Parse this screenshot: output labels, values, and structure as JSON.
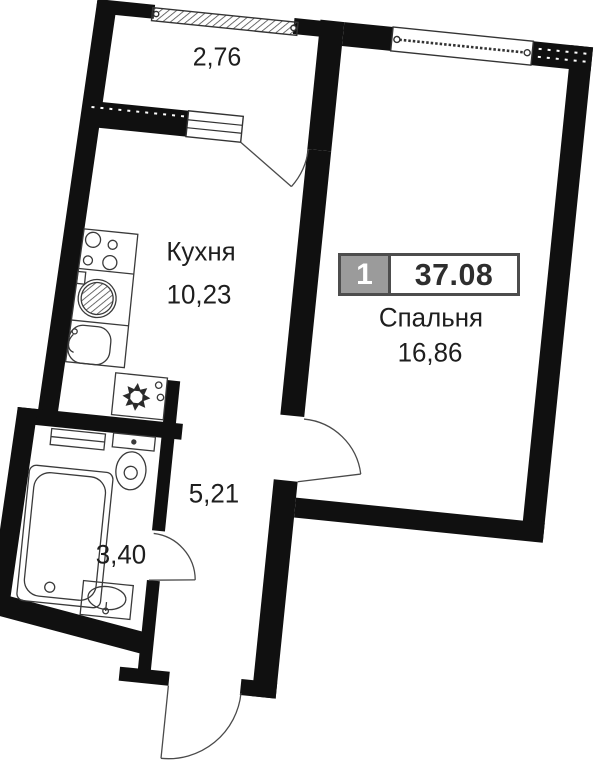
{
  "floorplan": {
    "badge": {
      "unit_number": "1",
      "total_area": "37.08"
    },
    "labels": {
      "balcony_area": "2,76",
      "kitchen_name": "Кухня",
      "kitchen_area": "10,23",
      "bedroom_name": "Спальня",
      "bedroom_area": "16,86",
      "hall_area": "5,21",
      "bath_area": "3,40"
    },
    "colors": {
      "wall": "#101010",
      "fixture_line": "#3a3a3a",
      "text": "#1e1e1e",
      "badge_gray": "#9b9b9b",
      "badge_border": "#4d4d4d",
      "badge_value": "#2e2e2e",
      "background": "#ffffff"
    },
    "icons": [
      "stove-icon",
      "round-sink-icon",
      "basin-icon",
      "fridge-icon",
      "shelf-icon",
      "toilet-icon",
      "bathtub-icon",
      "washbasin-icon",
      "bedroom-window-icon",
      "kitchen-window-icon",
      "balcony-glazing-icon",
      "balcony-door-icon",
      "bedroom-door-icon",
      "bathroom-door-icon",
      "entry-door-icon"
    ]
  }
}
